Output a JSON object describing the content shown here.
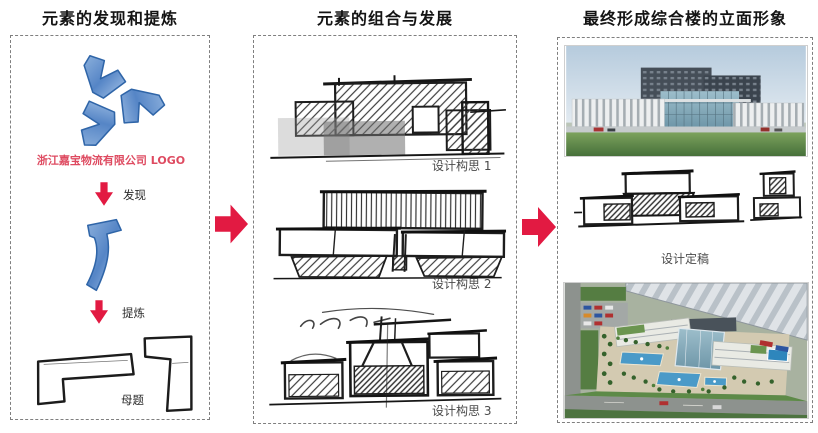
{
  "columns": {
    "left": {
      "title": "元素的发现和提炼",
      "logo_caption": "浙江嘉宝物流有限公司 LOGO",
      "steps": {
        "discover": "发现",
        "refine": "提炼",
        "motif": "母题"
      }
    },
    "middle": {
      "title": "元素的组合与发展",
      "concepts": [
        "设计构思 1",
        "设计构思 2",
        "设计构思 3"
      ]
    },
    "right": {
      "title": "最终形成综合楼的立面形象",
      "final_label": "设计定稿"
    }
  },
  "icons": {
    "flow": "right-arrow-icon",
    "step": "down-arrow-icon",
    "logo": "logo-pinwheel-icon"
  },
  "colors": {
    "arrow_red": "#e21a42",
    "caption_red": "#de4a60",
    "logo_blue": "#4d80c4",
    "logo_blue_dark": "#2f65a8",
    "label_gray": "#4a4a4a",
    "title_black": "#141414",
    "border_gray": "#7f7f7f"
  }
}
